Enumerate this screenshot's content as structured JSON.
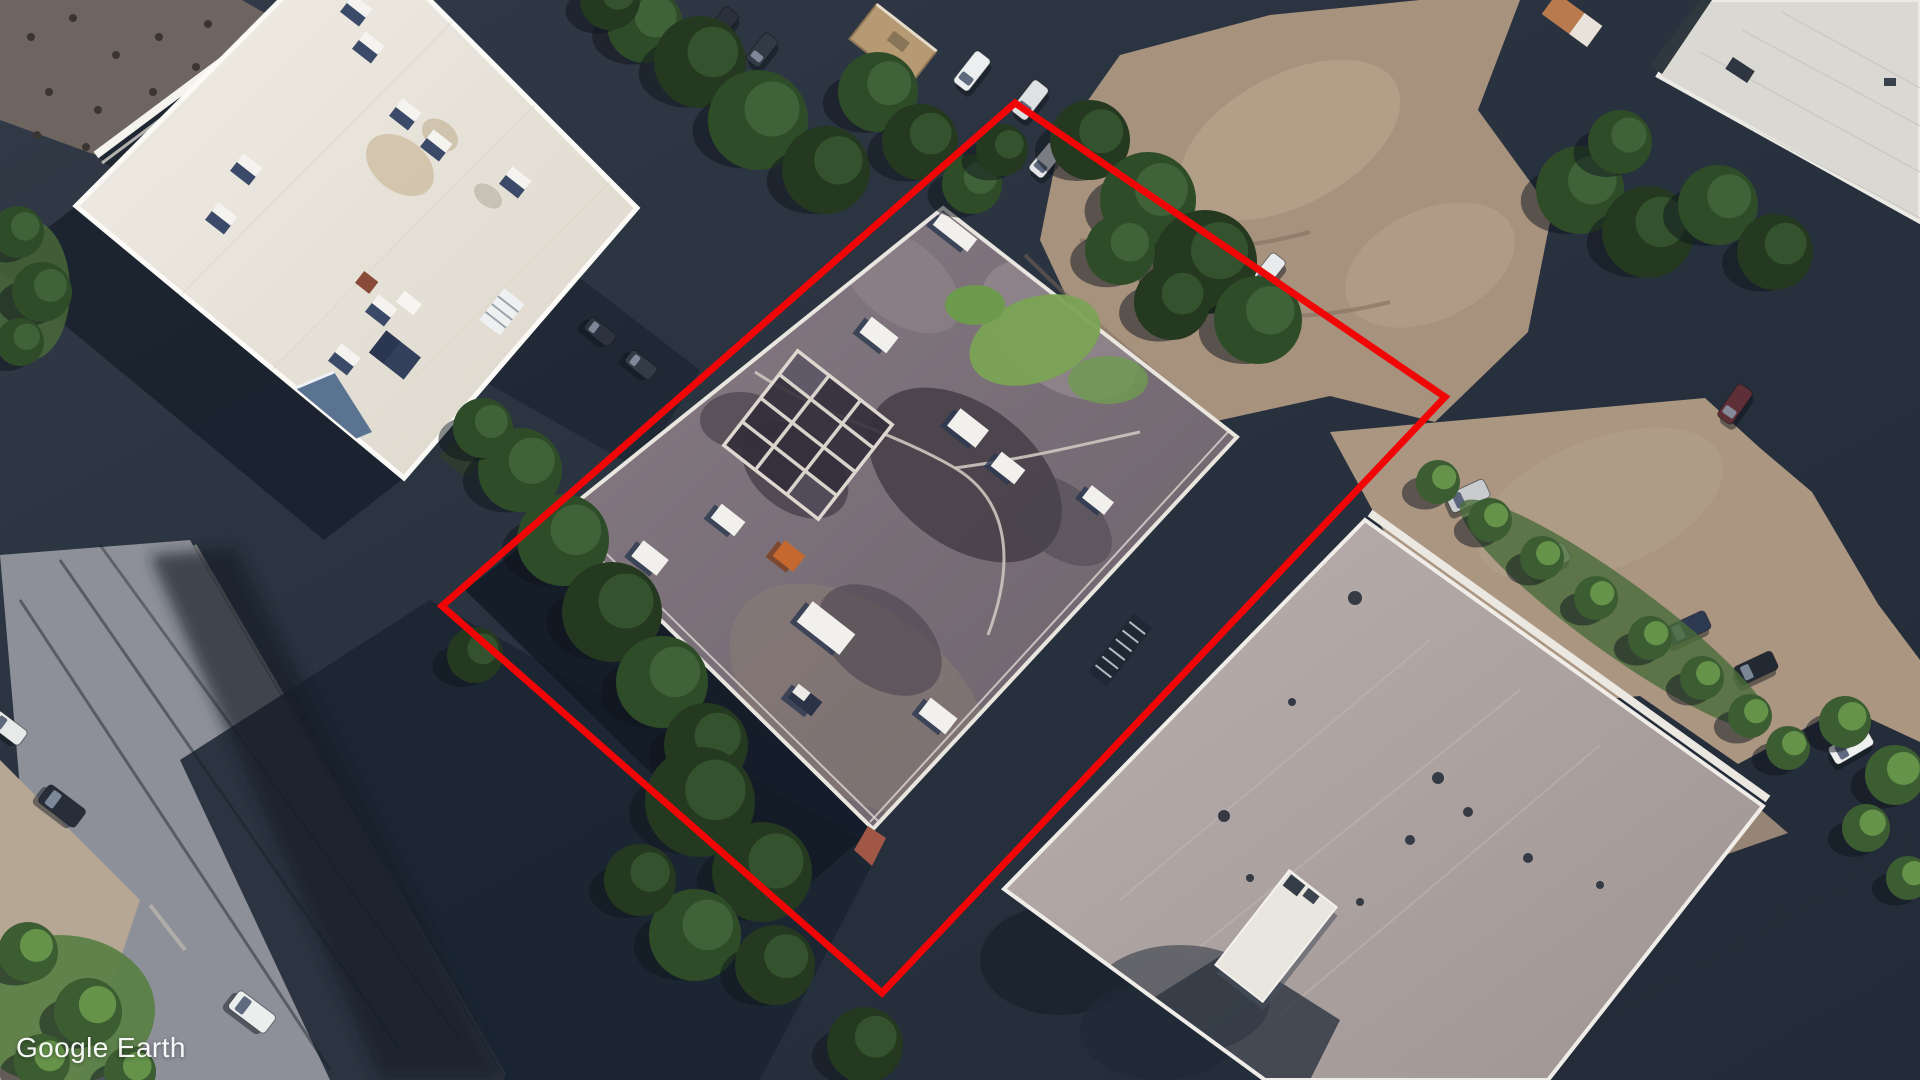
{
  "watermark": {
    "text": "Google Earth",
    "color": "#ffffff"
  },
  "annotation": {
    "label": "property-boundary-outline",
    "color": "#f00606",
    "stroke_width": 7,
    "points": "1015,103 1445,397 882,993 442,606"
  },
  "scene": {
    "description": "Aerial satellite view of industrial buildings with red property outline",
    "palette": {
      "asphalt_dark": "#242d3a",
      "dirt": "#a7927e",
      "street": "#8d9099",
      "white_roof": "#efece5",
      "subject_roof": "#7f747c",
      "pink_roof": "#b2a8a5",
      "tree_dark": "#2f4c29",
      "grass": "#7ba355",
      "annotation_red": "#f00606"
    },
    "trees": [
      [
        520,
        470,
        42,
        1
      ],
      [
        563,
        540,
        46,
        1
      ],
      [
        612,
        612,
        50,
        0
      ],
      [
        662,
        682,
        46,
        1
      ],
      [
        706,
        745,
        42,
        0
      ],
      [
        483,
        428,
        30,
        1
      ],
      [
        475,
        655,
        28,
        0
      ],
      [
        700,
        802,
        55,
        0
      ],
      [
        762,
        872,
        50,
        0
      ],
      [
        695,
        935,
        46,
        1
      ],
      [
        775,
        965,
        40,
        0
      ],
      [
        640,
        880,
        36,
        0
      ],
      [
        865,
        1045,
        38,
        0
      ],
      [
        645,
        25,
        38,
        1
      ],
      [
        700,
        62,
        46,
        0
      ],
      [
        758,
        120,
        50,
        1
      ],
      [
        826,
        170,
        44,
        0
      ],
      [
        878,
        92,
        40,
        1
      ],
      [
        920,
        142,
        38,
        0
      ],
      [
        972,
        184,
        30,
        1
      ],
      [
        1002,
        150,
        26,
        0
      ],
      [
        610,
        0,
        30,
        0
      ],
      [
        1090,
        140,
        40,
        0
      ],
      [
        1148,
        200,
        48,
        1
      ],
      [
        1205,
        262,
        52,
        0
      ],
      [
        1258,
        320,
        44,
        1
      ],
      [
        1172,
        302,
        38,
        0
      ],
      [
        1120,
        250,
        35,
        1
      ],
      [
        1580,
        190,
        44,
        1
      ],
      [
        1648,
        232,
        46,
        0
      ],
      [
        1718,
        205,
        40,
        1
      ],
      [
        1775,
        252,
        38,
        0
      ],
      [
        1620,
        142,
        32,
        1
      ],
      [
        18,
        232,
        26,
        1
      ],
      [
        42,
        292,
        30,
        1
      ],
      [
        20,
        342,
        24,
        1
      ],
      [
        28,
        952,
        30,
        2
      ],
      [
        88,
        1012,
        34,
        2
      ],
      [
        42,
        1062,
        28,
        2
      ],
      [
        130,
        1072,
        26,
        2
      ],
      [
        1438,
        482,
        22,
        2
      ],
      [
        1490,
        520,
        22,
        2
      ],
      [
        1542,
        558,
        22,
        2
      ],
      [
        1596,
        598,
        22,
        2
      ],
      [
        1650,
        638,
        22,
        2
      ],
      [
        1702,
        678,
        22,
        2
      ],
      [
        1750,
        716,
        22,
        2
      ],
      [
        1788,
        748,
        22,
        2
      ],
      [
        1845,
        722,
        26,
        2
      ],
      [
        1895,
        775,
        30,
        2
      ],
      [
        1866,
        828,
        24,
        2
      ],
      [
        1908,
        878,
        22,
        2
      ]
    ],
    "cars": [
      [
        722,
        25,
        -52,
        36,
        18,
        "#2a313d"
      ],
      [
        762,
        50,
        -52,
        34,
        17,
        "#323a46"
      ],
      [
        972,
        71,
        -52,
        40,
        19,
        "#eceff0"
      ],
      [
        1030,
        100,
        -52,
        40,
        19,
        "#dfe2e4"
      ],
      [
        1082,
        131,
        -52,
        38,
        18,
        "#e9ebec"
      ],
      [
        1046,
        160,
        -50,
        36,
        18,
        "#e4e6e8"
      ],
      [
        1172,
        197,
        -52,
        40,
        19,
        "#c6c9cd"
      ],
      [
        1268,
        272,
        -52,
        38,
        18,
        "#e8eaeb"
      ],
      [
        1735,
        404,
        -55,
        40,
        18,
        "#5f2f37"
      ],
      [
        1468,
        496,
        -25,
        42,
        20,
        "#c9cbce"
      ],
      [
        1549,
        560,
        -28,
        42,
        20,
        "#d6d8da"
      ],
      [
        1688,
        628,
        -25,
        44,
        20,
        "#2e3a52"
      ],
      [
        1756,
        668,
        -25,
        42,
        20,
        "#232933"
      ],
      [
        1851,
        746,
        -30,
        44,
        20,
        "#eff0f0"
      ],
      [
        62,
        806,
        37,
        46,
        22,
        "#272e3a"
      ],
      [
        252,
        1012,
        37,
        46,
        22,
        "#eceeee"
      ],
      [
        8,
        728,
        37,
        38,
        18,
        "#e8eaea"
      ],
      [
        600,
        332,
        38,
        32,
        16,
        "#2c333f"
      ],
      [
        641,
        365,
        38,
        32,
        16,
        "#333b47"
      ]
    ],
    "white_roof_vents": [
      [
        367,
        49
      ],
      [
        404,
        116
      ],
      [
        435,
        147
      ],
      [
        514,
        184
      ],
      [
        245,
        171
      ],
      [
        220,
        220
      ],
      [
        380,
        312
      ],
      [
        343,
        361
      ],
      [
        355,
        12
      ]
    ],
    "subject_roof_units": [
      [
        955,
        232,
        44,
        16,
        "w"
      ],
      [
        940,
        196,
        38,
        12,
        "w"
      ],
      [
        879,
        335,
        34,
        20,
        "w"
      ],
      [
        968,
        428,
        36,
        22,
        "w"
      ],
      [
        1008,
        468,
        30,
        18,
        "w"
      ],
      [
        728,
        520,
        30,
        18,
        "w"
      ],
      [
        650,
        558,
        32,
        20,
        "w"
      ],
      [
        789,
        556,
        26,
        20,
        "o"
      ],
      [
        826,
        628,
        54,
        26,
        "w"
      ],
      [
        938,
        716,
        34,
        20,
        "w"
      ],
      [
        805,
        700,
        30,
        18,
        "n"
      ],
      [
        1098,
        500,
        28,
        16,
        "w"
      ]
    ],
    "b1_roof_dots": [
      [
        31,
        37
      ],
      [
        73,
        18
      ],
      [
        116,
        55
      ],
      [
        159,
        37
      ],
      [
        49,
        92
      ],
      [
        98,
        110
      ],
      [
        153,
        92
      ],
      [
        196,
        67
      ],
      [
        37,
        135
      ],
      [
        86,
        147
      ],
      [
        208,
        24
      ],
      [
        239,
        49
      ]
    ],
    "b4_roof_dots": [
      [
        1355,
        598,
        7
      ],
      [
        1224,
        816,
        6
      ],
      [
        1438,
        778,
        6
      ],
      [
        1468,
        812,
        5
      ],
      [
        1410,
        840,
        5
      ],
      [
        1292,
        702,
        4
      ],
      [
        1528,
        858,
        5
      ],
      [
        1600,
        885,
        4
      ],
      [
        1360,
        902,
        4
      ],
      [
        1250,
        878,
        4
      ]
    ]
  }
}
